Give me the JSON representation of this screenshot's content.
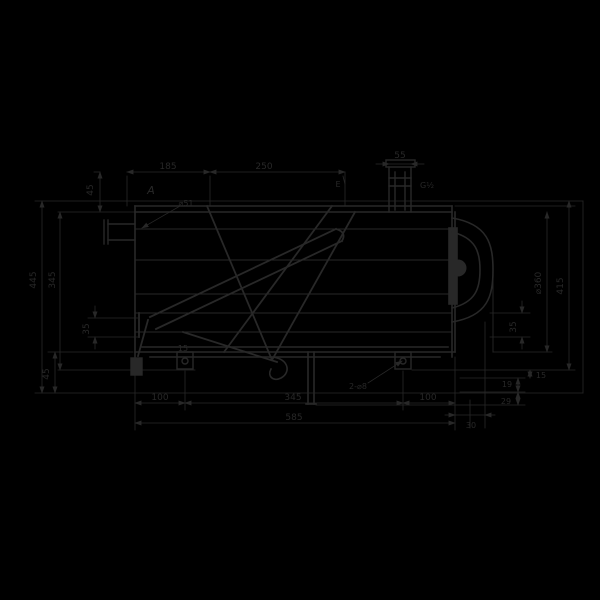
{
  "colors": {
    "background": "#000000",
    "ink": "#282828"
  },
  "labels": {
    "top_left_45": "45",
    "top_185": "185",
    "top_250": "250",
    "top_55": "55",
    "view_a": "A",
    "dia_51": "⌀51",
    "thread_g12": "G½",
    "point_e": "E",
    "left_445": "445",
    "left_345": "345",
    "left_35": "35",
    "bottom_left_45": "45",
    "bracket_15": "15",
    "bottom_100_left": "100",
    "bottom_345": "345",
    "bottom_100_right": "100",
    "bottom_585": "585",
    "holes_note": "2-⌀8",
    "right_dia_360": "⌀360",
    "right_415": "415",
    "right_35": "35",
    "right_19": "19",
    "right_29": "29",
    "right_15": "15",
    "bottom_right_30": "30"
  }
}
